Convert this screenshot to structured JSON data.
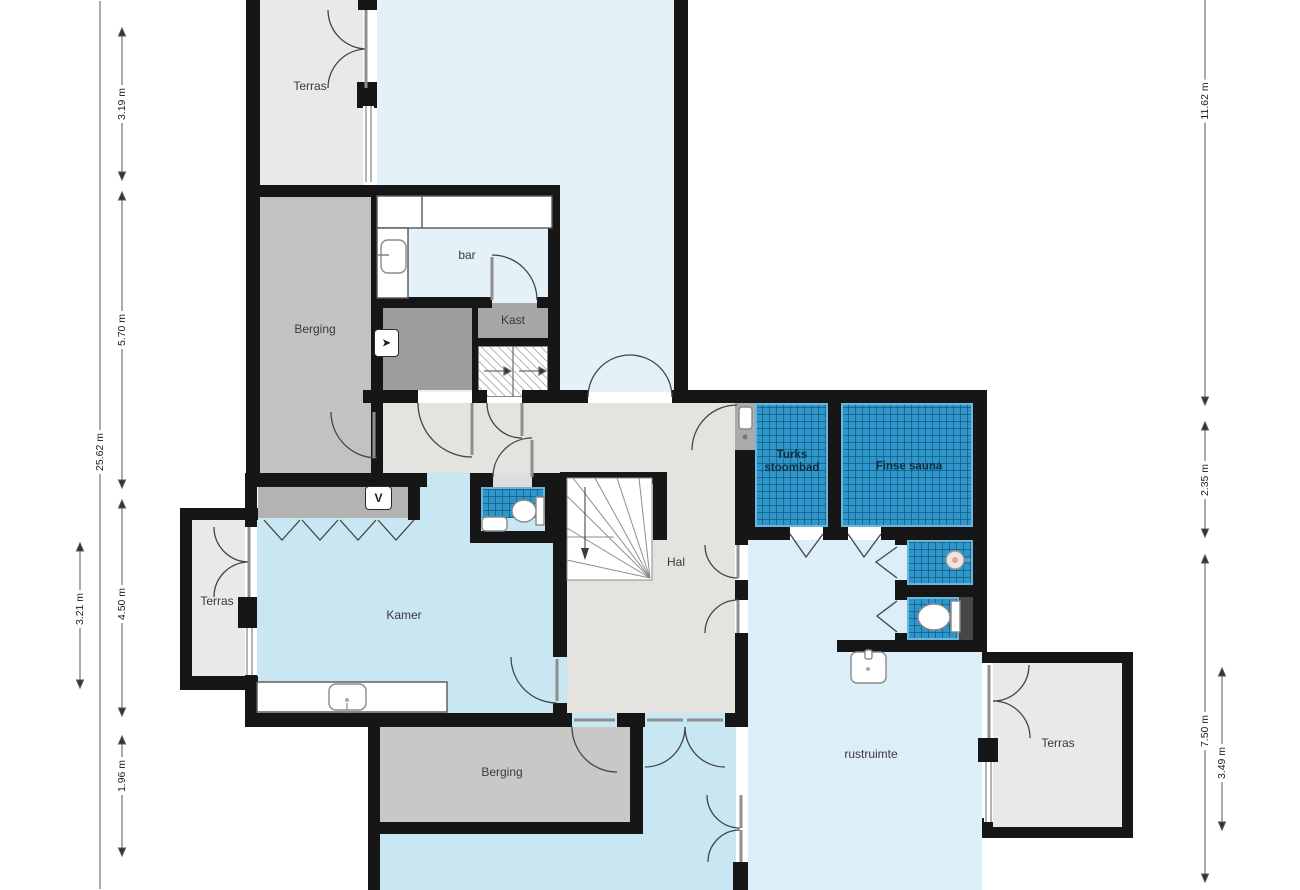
{
  "plan_title": "floor plan",
  "rooms": [
    {
      "id": "terras-top",
      "label": "Terras"
    },
    {
      "id": "bar",
      "label": "bar"
    },
    {
      "id": "berging-top",
      "label": "Berging"
    },
    {
      "id": "kast",
      "label": "Kast"
    },
    {
      "id": "turks-stoombad",
      "label": "Turks stoombad"
    },
    {
      "id": "finse-sauna",
      "label": "Finse sauna"
    },
    {
      "id": "hal",
      "label": "Hal"
    },
    {
      "id": "terras-left",
      "label": "Terras"
    },
    {
      "id": "kamer",
      "label": "Kamer"
    },
    {
      "id": "berging-bottom",
      "label": "Berging"
    },
    {
      "id": "rustruimte",
      "label": "rustruimte"
    },
    {
      "id": "terras-right",
      "label": "Terras"
    }
  ],
  "dimensions": {
    "left_outer": {
      "value": "25.62 m"
    },
    "left_inner": [
      {
        "value": "3.19 m"
      },
      {
        "value": "5.70 m"
      },
      {
        "value": "4.50 m"
      },
      {
        "value": "1.96 m"
      }
    ],
    "left_terras": {
      "value": "3.21 m"
    },
    "right_outer": [
      {
        "value": "11.62 m"
      },
      {
        "value": "2.35 m"
      },
      {
        "value": "7.50 m"
      }
    ],
    "right_terras": {
      "value": "3.49 m"
    }
  },
  "icons": {
    "boiler_glyph": "➤",
    "hook_glyph": "V"
  },
  "colors": {
    "wall": "#161616",
    "tile_blue": "#2f96c9",
    "pale_blue": "#e4f1f8",
    "light_blue": "#c9e7f3",
    "rust_blue": "#dceef8",
    "terras_gray": "#e9e9e9",
    "berging_gray": "#c2c2c2",
    "hall_gray": "#e4e3df",
    "vestibule_gray": "#b3b3b3",
    "dark_room_gray": "#9d9d9d"
  }
}
